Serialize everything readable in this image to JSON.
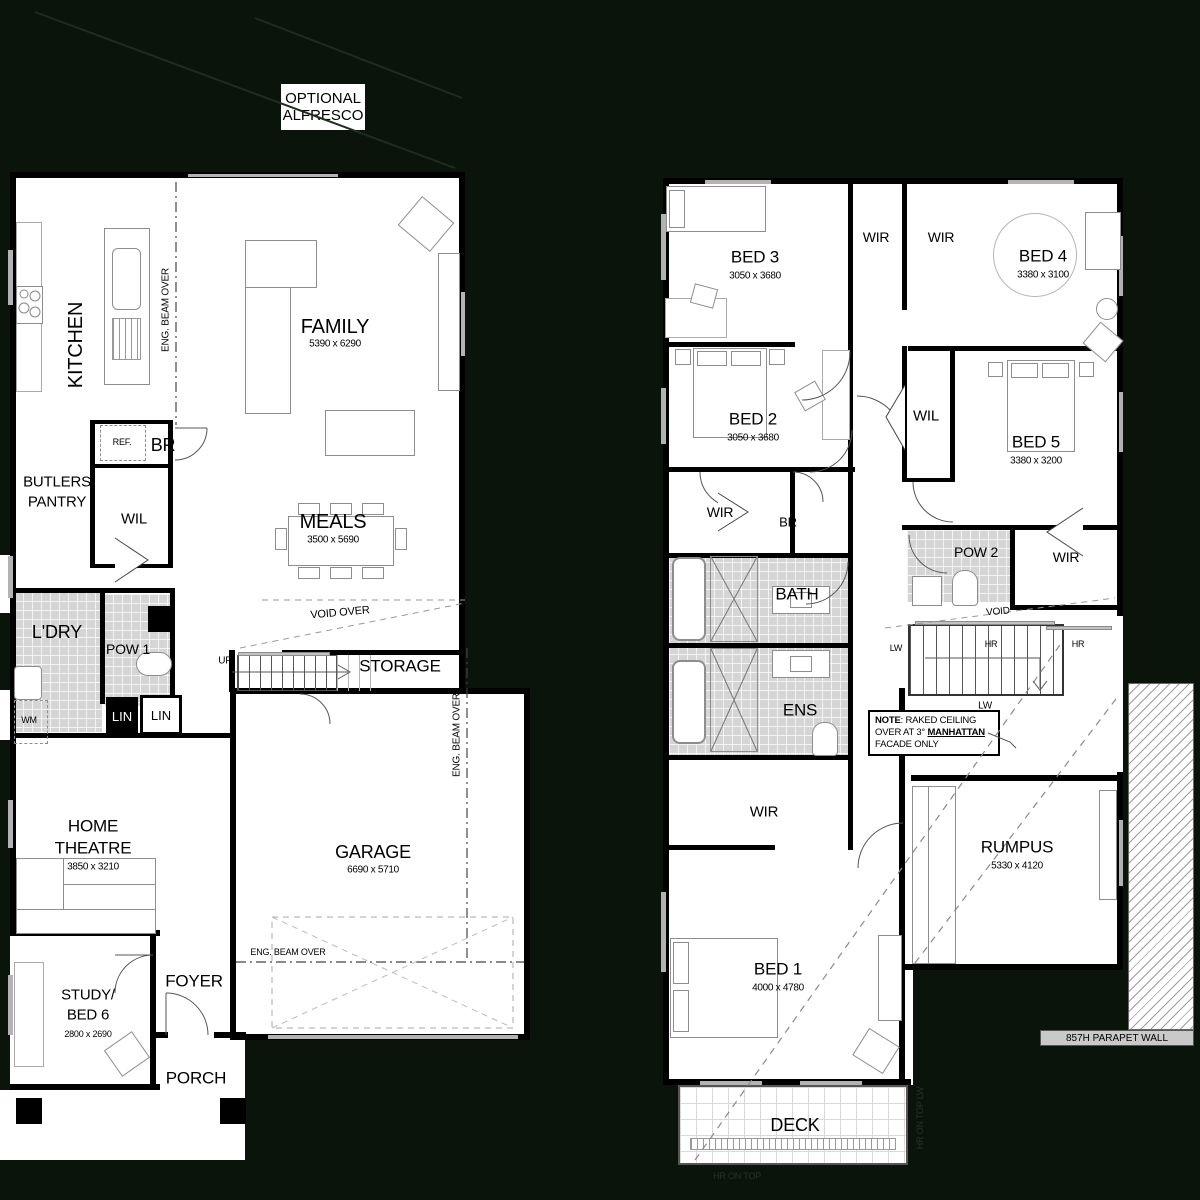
{
  "colors": {
    "background": "#0b140b",
    "plan_floor": "#ffffff",
    "walls": "#000000",
    "wet_area_tile": "#d5d5d5",
    "furniture_outline": "#8d8d8d"
  },
  "shared": {
    "wir": "WIR",
    "wil": "WIL",
    "lin": "LIN",
    "br": "BR",
    "lw": "LW",
    "hr": "HR",
    "up": "UP",
    "wm": "WM",
    "ref": "REF.",
    "void": "VOID",
    "void_over": "VOID OVER",
    "eng_beam_over": "ENG. BEAM OVER"
  },
  "header": {
    "optional_alfresco_line1": "OPTIONAL",
    "optional_alfresco_line2": "ALFRESCO"
  },
  "ground": {
    "kitchen": {
      "label": "KITCHEN"
    },
    "family": {
      "label": "FAMILY",
      "dims": "5390 x 6290"
    },
    "butlers": {
      "line1": "BUTLERS",
      "line2": "PANTRY"
    },
    "meals": {
      "label": "MEALS",
      "dims": "3500 x 5690"
    },
    "ldry": {
      "label": "L'DRY"
    },
    "pow1": {
      "label": "POW 1"
    },
    "storage": {
      "label": "STORAGE"
    },
    "home_theatre": {
      "line1": "HOME",
      "line2": "THEATRE",
      "dims": "3850 x 3210"
    },
    "garage": {
      "label": "GARAGE",
      "dims": "6690 x 5710"
    },
    "study": {
      "line1": "STUDY/",
      "line2": "BED 6",
      "dims": "2800 x 2690"
    },
    "foyer": {
      "label": "FOYER"
    },
    "porch": {
      "label": "PORCH"
    }
  },
  "upper": {
    "bed1": {
      "label": "BED 1",
      "dims": "4000 x 4780"
    },
    "bed2": {
      "label": "BED 2",
      "dims": "3050 x 3680"
    },
    "bed3": {
      "label": "BED 3",
      "dims": "3050 x 3680"
    },
    "bed4": {
      "label": "BED 4",
      "dims": "3380 x 3100"
    },
    "bed5": {
      "label": "BED 5",
      "dims": "3380 x 3200"
    },
    "pow2": {
      "label": "POW 2"
    },
    "bath": {
      "label": "BATH"
    },
    "ens": {
      "label": "ENS"
    },
    "rumpus": {
      "label": "RUMPUS",
      "dims": "5330 x 4120"
    },
    "deck": {
      "label": "DECK"
    },
    "note": {
      "line1_bold": "NOTE",
      "line1_rest": ": RAKED CEILING",
      "line2_pre": "OVER AT 3° ",
      "line2_bold": "MANHATTAN",
      "line3": "FACADE ONLY"
    },
    "deck_rail_bottom": "HR ON TOP",
    "deck_rail_side": "HR ON TOP LW",
    "parapet": "857H PARAPET WALL"
  }
}
